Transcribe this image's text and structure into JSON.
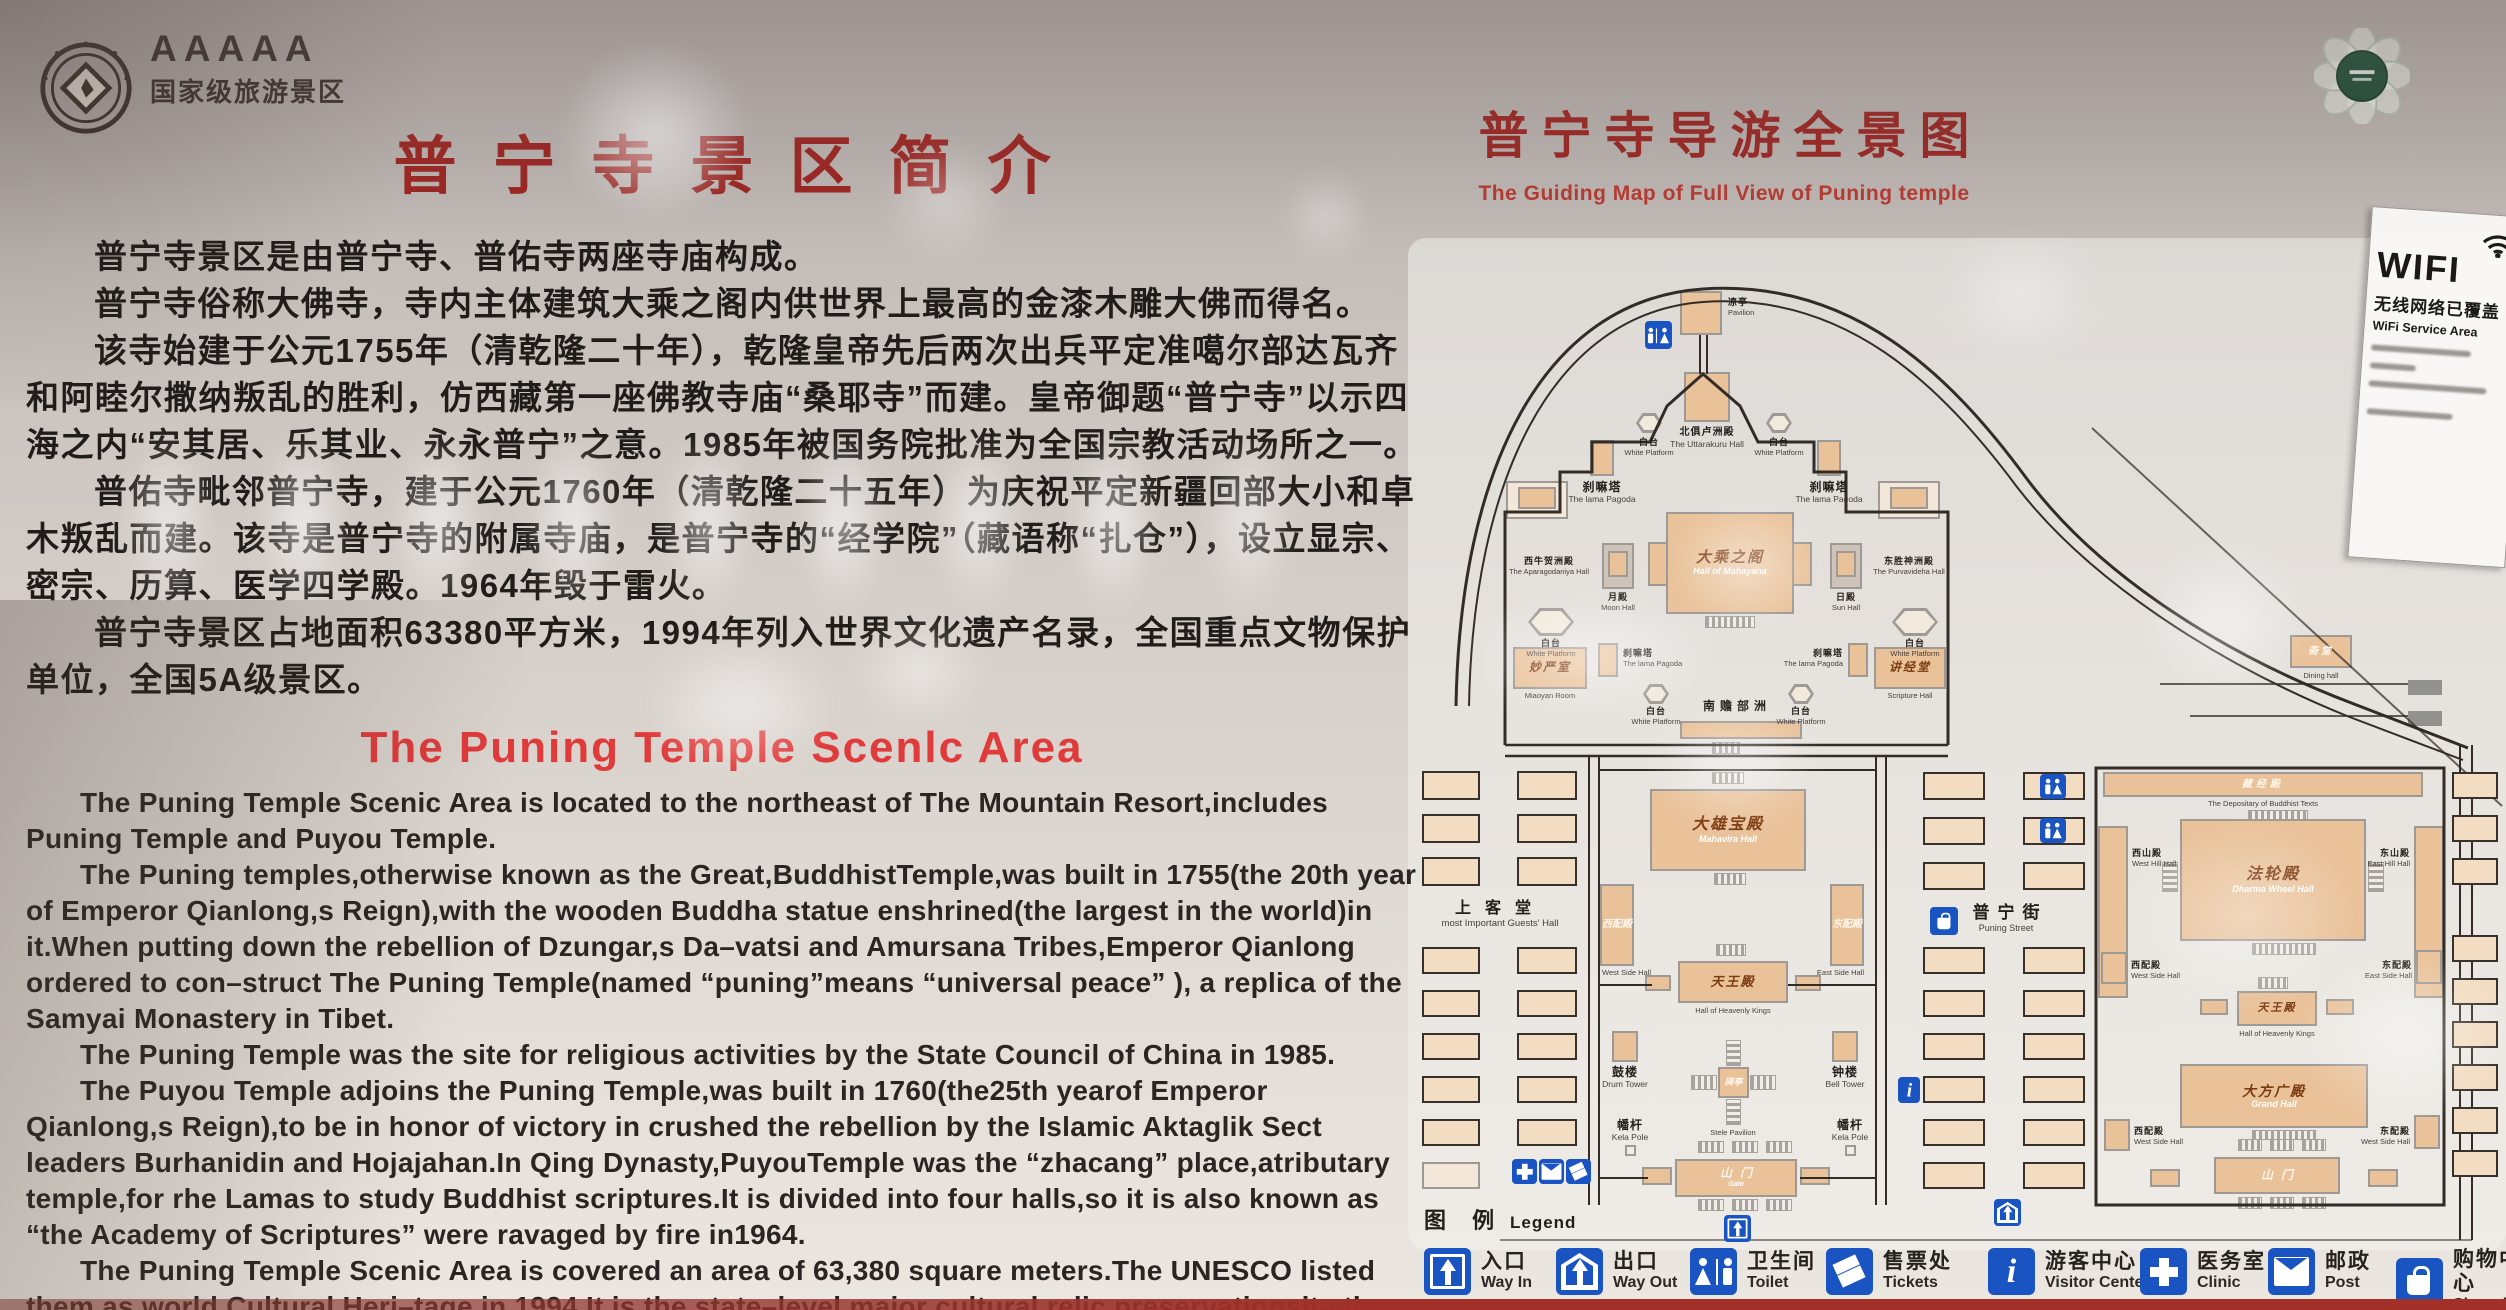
{
  "header": {
    "badge_stars": "AAAAA",
    "badge_text": "国家级旅游景区"
  },
  "intro": {
    "title": "普宁寺景区简介",
    "paragraphs": [
      "普宁寺景区是由普宁寺、普佑寺两座寺庙构成。",
      "普宁寺俗称大佛寺，寺内主体建筑大乘之阁内供世界上最高的金漆木雕大佛而得名。",
      "该寺始建于公元1755年（清乾隆二十年），乾隆皇帝先后两次出兵平定准噶尔部达瓦齐和阿睦尔撒纳叛乱的胜利，仿西藏第一座佛教寺庙“桑耶寺”而建。皇帝御题“普宁寺”以示四海之内“安其居、乐其业、永永普宁”之意。1985年被国务院批准为全国宗教活动场所之一。",
      "普佑寺毗邻普宁寺，建于公元1760年（清乾隆二十五年）为庆祝平定新疆回部大小和卓木叛乱而建。该寺是普宁寺的附属寺庙，是普宁寺的“经学院”（藏语称“扎仓”），设立显宗、密宗、历算、医学四学殿。1964年毁于雷火。",
      "普宁寺景区占地面积63380平方米，1994年列入世界文化遗产名录，全国重点文物保护单位，全国5A级景区。"
    ],
    "en_title": "The Puning Temple Scenlc Area",
    "en_paragraphs": [
      "The Puning Temple Scenic Area is located to the northeast of The Mountain Resort,includes Puning Temple and Puyou Temple.",
      "The Puning temples,otherwise known as the Great,BuddhistTemple,was built in 1755(the 20th year of Emperor Qianlong,s Reign),with the wooden Buddha statue enshrined(the largest in the world)in it.When putting down the rebellion of Dzungar,s Da–vatsi and Amursana Tribes,Emperor Qianlong ordered to con–struct The Puning Temple(named “puning”means “universal peace” ), a replica of the Samyai Monastery in Tibet.",
      "The Puning Temple was the site for religious activities by the State Council of China in 1985.",
      "The Puyou Temple adjoins the Puning Temple,was built in 1760(the25th yearof Emperor Qianlong,s Reign),to be in honor of victory in crushed the rebellion by the Islamic Aktaglik Sect leaders Burhanidin and Hojajahan.In Qing Dynasty,PuyouTemple was the “zhacang” place,atributary temple,for rhe Lamas to study Buddhist scriptures.It is divided into four halls,so it is also known as “the Academy of Scriptures” were ravaged by fire in1964.",
      "The Puning Temple Scenic Area is covered an area of 63,380 square meters.The UNESCO listed them as world Cultural Heri–tage in 1994.It is the state–level major cultural relic preservationsite,the national 5A–level scenic area."
    ]
  },
  "map": {
    "title": "普宁寺导游全景图",
    "subtitle": "The Guiding Map of Full View of Puning temple",
    "wifi": {
      "big": "WIFI",
      "cn": "无线网络已覆盖",
      "en": "WiFi Service Area"
    },
    "legend_cn": "图 例",
    "legend_en": "Legend",
    "legend": [
      {
        "cn": "入口",
        "en": "Way In"
      },
      {
        "cn": "出口",
        "en": "Way Out"
      },
      {
        "cn": "卫生间",
        "en": "Toilet"
      },
      {
        "cn": "售票处",
        "en": "Tickets"
      },
      {
        "cn": "游客中心",
        "en": "Visitor Center"
      },
      {
        "cn": "医务室",
        "en": "Clinic"
      },
      {
        "cn": "邮政",
        "en": "Post"
      },
      {
        "cn": "购物中心",
        "en": "Shopping"
      }
    ],
    "labels": {
      "pavilion": {
        "cn": "凉亭",
        "en": "Pavilion"
      },
      "uttarakuru": {
        "cn": "北俱卢洲殿",
        "en": "The Uttarakuru Hall"
      },
      "white_platform": {
        "cn": "白台",
        "en": "White Platform"
      },
      "lama_pagoda": {
        "cn": "刹嘛塔",
        "en": "The lama Pagoda"
      },
      "aparagodaniya": {
        "cn": "西牛贺洲殿",
        "en": "The Aparagodaniya Hall"
      },
      "purvavideha": {
        "cn": "东胜神洲殿",
        "en": "The Purvavideha Hall"
      },
      "moon_hall": {
        "cn": "月殿",
        "en": "Moon Hall"
      },
      "sun_hall": {
        "cn": "日殿",
        "en": "Sun Hall"
      },
      "mahayana": {
        "cn": "大乘之阁",
        "en": "Hall of Mahayana"
      },
      "miaoyan": {
        "cn": "妙严室",
        "en": "Miaoyan Room"
      },
      "sutra_hall": {
        "cn": "讲经堂",
        "en": "Scripture Hall"
      },
      "nanzhanbuzhou": {
        "cn": "南赡部洲"
      },
      "mahavira": {
        "cn": "大雄宝殿",
        "en": "Mahavira Hall"
      },
      "west_side_hall": {
        "cn": "西配殿",
        "en": "West Side Hall"
      },
      "east_side_hall": {
        "cn": "东配殿",
        "en": "East Side Hall"
      },
      "heavenly_kings": {
        "cn": "天王殿",
        "en": "Hall of Heavenly Kings"
      },
      "guests_hall": {
        "cn": "上客堂",
        "en": "most Important Guests'  Hall"
      },
      "puning_street": {
        "cn": "普宁街",
        "en": "Puning Street"
      },
      "drum_tower": {
        "cn": "鼓楼",
        "en": "Drum Tower"
      },
      "bell_tower": {
        "cn": "钟楼",
        "en": "Bell Tower"
      },
      "stele_pavilion": {
        "cn": "碑亭",
        "en": "Stele Pavilion"
      },
      "kela_pole": {
        "cn": "幡杆",
        "en": "Kela Pole"
      },
      "gate": {
        "cn": "山门",
        "en": "Gate"
      },
      "depositary": {
        "cn": "藏经殿",
        "en": "The Depositary of Buddhist Texts"
      },
      "dharma_wheel": {
        "cn": "法轮殿",
        "en": "Dharma Wheel Hall"
      },
      "west_hill": {
        "cn": "西山殿",
        "en": "West Hill Hall"
      },
      "east_hill": {
        "cn": "东山殿",
        "en": "East Hill Hall"
      },
      "east_side_typo": {
        "cn": "东配殿",
        "en": "West Side Hall"
      },
      "grand_hall": {
        "cn": "大方广殿",
        "en": "Grand Hall"
      },
      "dining_hall": {
        "cn": "斋堂",
        "en": "Dining hall"
      }
    }
  }
}
